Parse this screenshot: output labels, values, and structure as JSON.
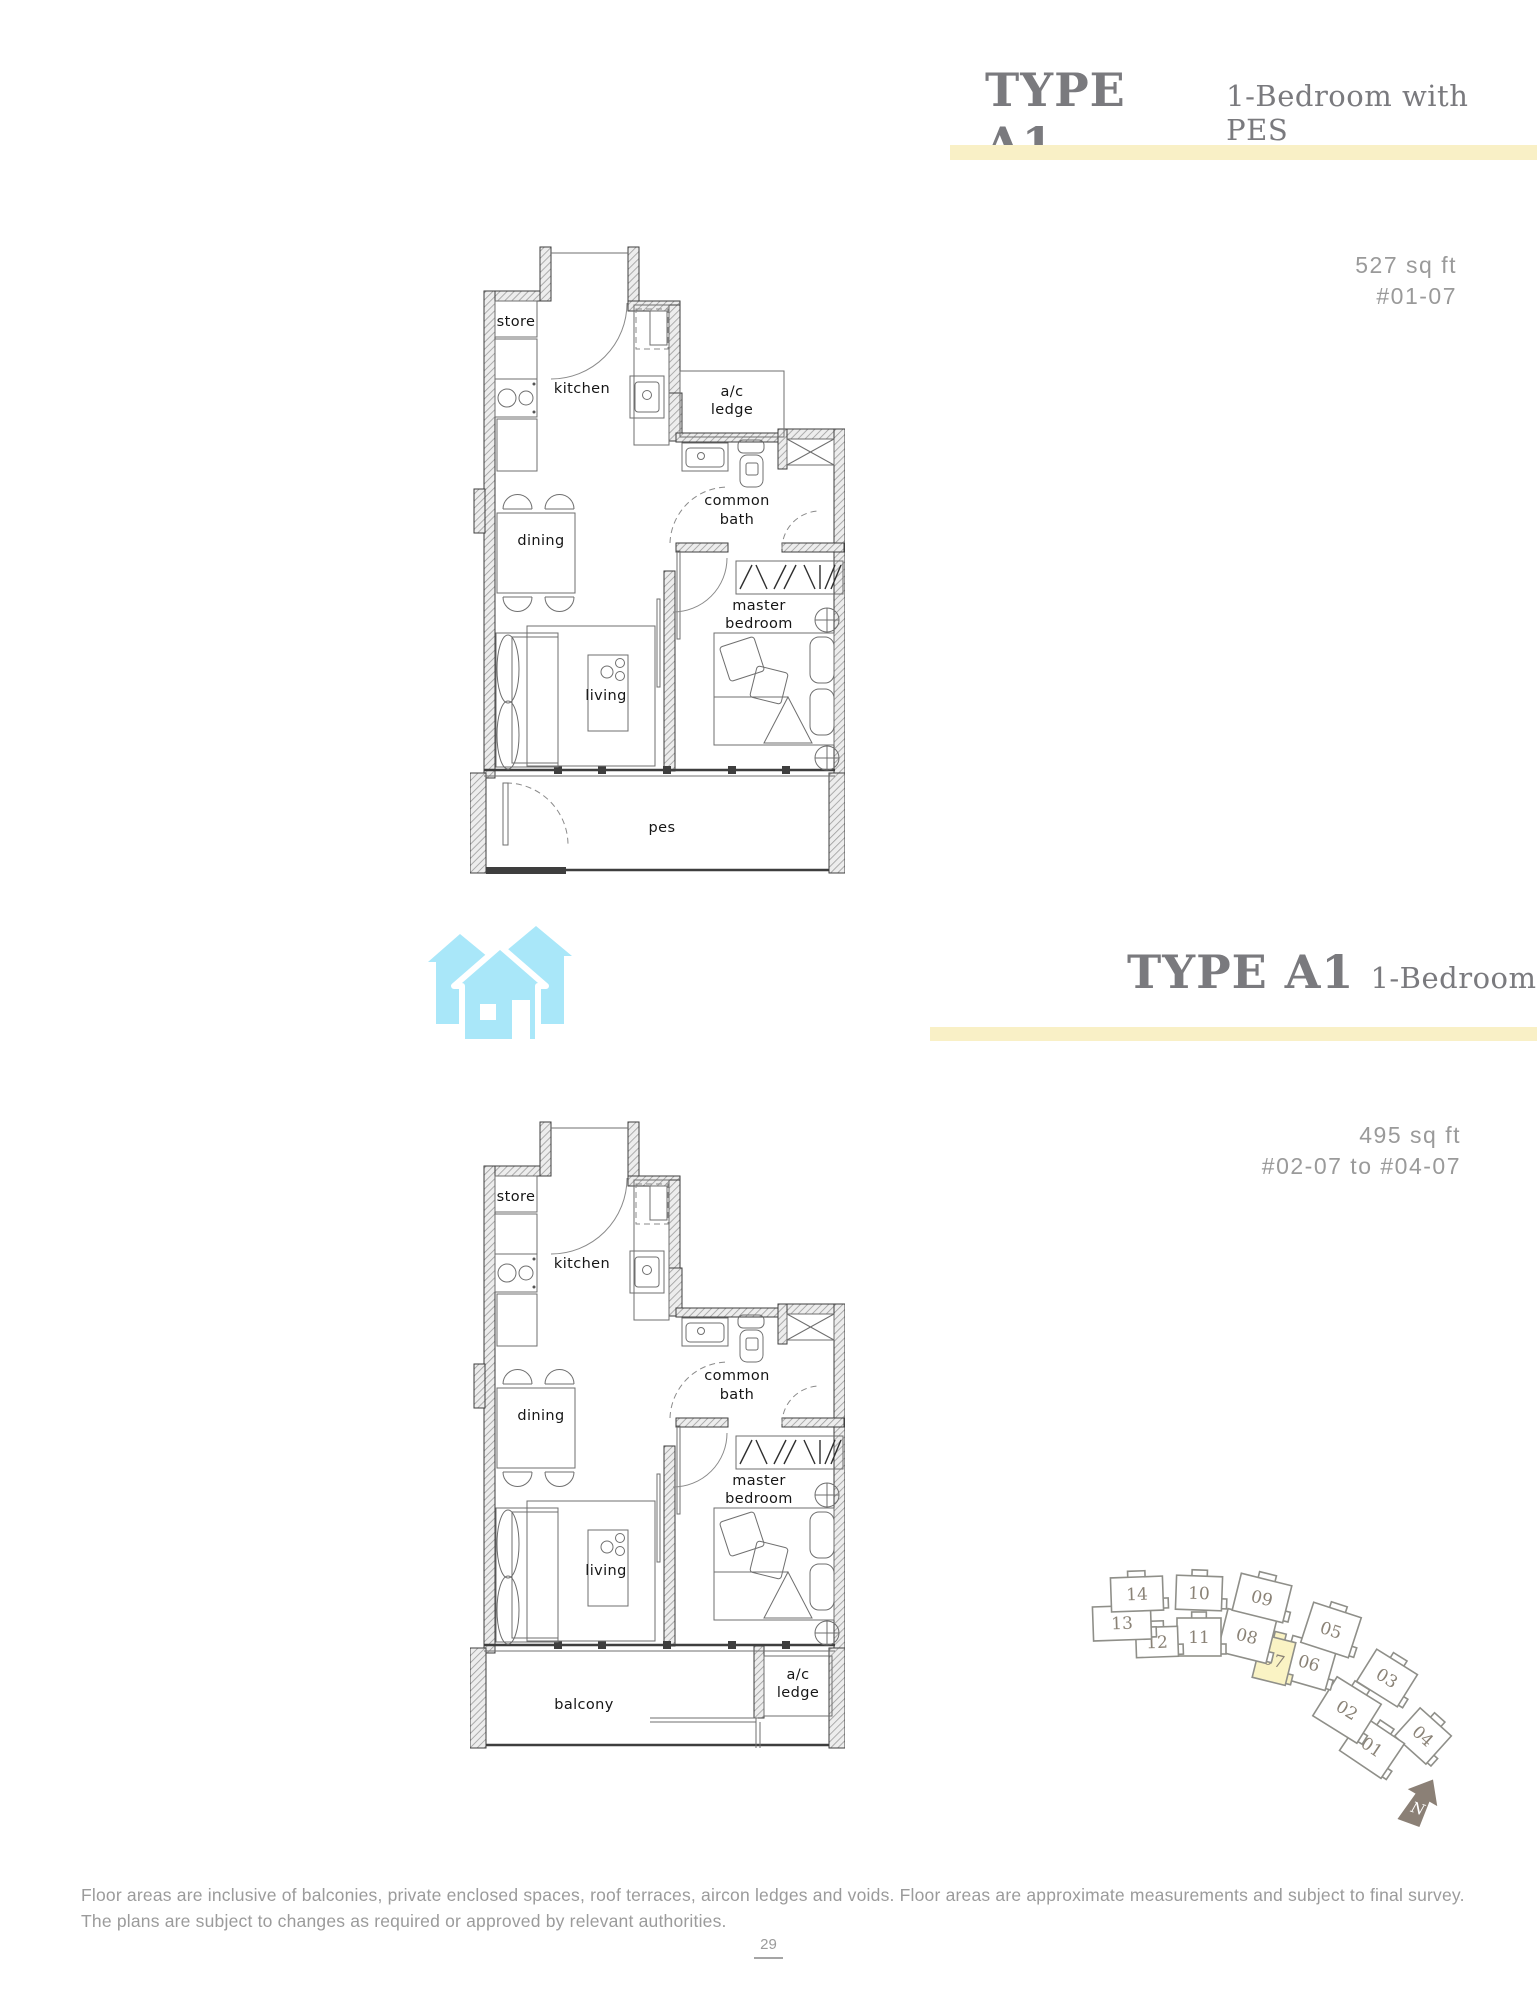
{
  "header_top": {
    "type": "TYPE A1",
    "subtitle": "1-Bedroom with PES",
    "area": "527 sq ft",
    "units": "#01-07"
  },
  "header_bottom": {
    "type": "TYPE A1",
    "subtitle": "1-Bedroom",
    "area": "495 sq ft",
    "units": "#02-07 to #04-07"
  },
  "plan_top_labels": {
    "store": "store",
    "kitchen": "kitchen",
    "ac1": "a/c",
    "ac2": "ledge",
    "bath1": "common",
    "bath2": "bath",
    "dining": "dining",
    "master1": "master",
    "master2": "bedroom",
    "living": "living",
    "outdoor": "pes"
  },
  "plan_bottom_labels": {
    "store": "store",
    "kitchen": "kitchen",
    "bath1": "common",
    "bath2": "bath",
    "dining": "dining",
    "master1": "master",
    "master2": "bedroom",
    "living": "living",
    "balcony": "balcony",
    "ac1": "a/c",
    "ac2": "ledge"
  },
  "site_map": {
    "north_label": "N",
    "highlight_unit": "07",
    "units": [
      {
        "id": "14",
        "x": 69,
        "y": 38,
        "w": 52,
        "h": 34,
        "rot": -2,
        "highlight": false
      },
      {
        "id": "10",
        "x": 131,
        "y": 37,
        "w": 46,
        "h": 34,
        "rot": 2,
        "highlight": false
      },
      {
        "id": "09",
        "x": 194,
        "y": 42,
        "w": 52,
        "h": 38,
        "rot": 14,
        "highlight": false
      },
      {
        "id": "13",
        "x": 54,
        "y": 67,
        "w": 58,
        "h": 34,
        "rot": -2,
        "highlight": false
      },
      {
        "id": "12",
        "x": 89,
        "y": 86,
        "w": 42,
        "h": 30,
        "rot": -2,
        "highlight": false
      },
      {
        "id": "11",
        "x": 131,
        "y": 81,
        "w": 44,
        "h": 38,
        "rot": 0,
        "highlight": false
      },
      {
        "id": "08",
        "x": 179,
        "y": 80,
        "w": 50,
        "h": 44,
        "rot": 14,
        "highlight": false
      },
      {
        "id": "05",
        "x": 263,
        "y": 74,
        "w": 50,
        "h": 42,
        "rot": 18,
        "highlight": false
      },
      {
        "id": "07",
        "x": 206,
        "y": 104,
        "w": 34,
        "h": 44,
        "rot": 14,
        "highlight": true
      },
      {
        "id": "06",
        "x": 241,
        "y": 107,
        "w": 46,
        "h": 44,
        "rot": 16,
        "highlight": false
      },
      {
        "id": "03",
        "x": 319,
        "y": 122,
        "w": 48,
        "h": 38,
        "rot": 32,
        "highlight": false
      },
      {
        "id": "02",
        "x": 279,
        "y": 154,
        "w": 52,
        "h": 46,
        "rot": 32,
        "highlight": false
      },
      {
        "id": "01",
        "x": 304,
        "y": 191,
        "w": 50,
        "h": 42,
        "rot": 34,
        "highlight": false
      },
      {
        "id": "04",
        "x": 355,
        "y": 180,
        "w": 42,
        "h": 38,
        "rot": 42,
        "highlight": false
      }
    ]
  },
  "colors": {
    "accent_band": "#f9f0c6",
    "title_gray": "#7a7a7e",
    "muted_gray": "#9a9a9a",
    "highlight_unit": "#faf3c4",
    "house_icon_blue": "#a9e7f9",
    "north_arrow": "#8b8076"
  },
  "footer": {
    "disclaimer": "Floor areas are inclusive of balconies, private enclosed spaces, roof terraces, aircon ledges and voids. Floor areas are approximate measurements and subject to final survey. The plans are subject to changes as required or approved by relevant authorities.",
    "page_number": "29"
  }
}
